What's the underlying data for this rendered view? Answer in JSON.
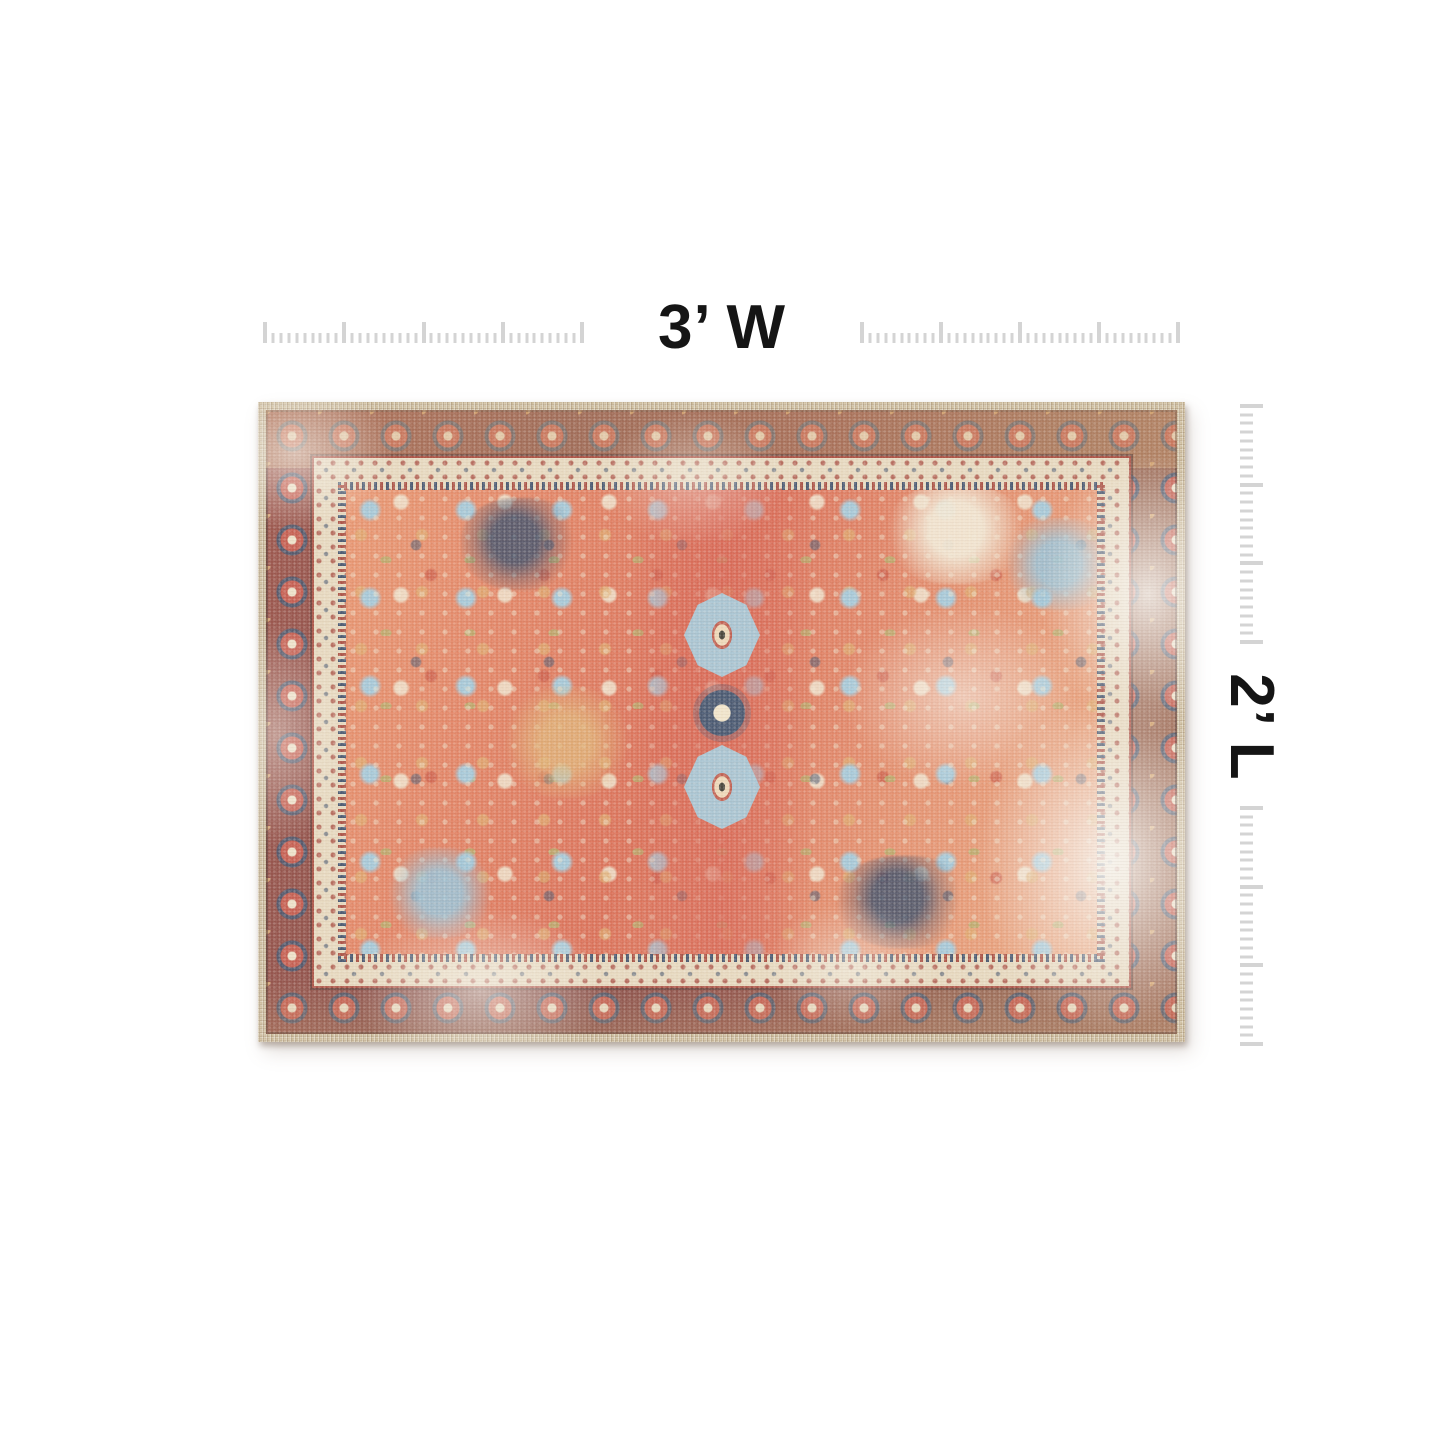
{
  "dimension_labels": {
    "width_label": "3’ W",
    "length_label": "2’ L"
  },
  "rulers": {
    "horizontal": {
      "majors": 5,
      "minors_between": 9
    },
    "vertical": {
      "majors": 4,
      "minors_between": 8
    }
  },
  "rug": {
    "alt": "Distressed vintage-style oriental area rug, terracotta field with multicolor medallion pattern and maroon rosette border",
    "width": "3 ft",
    "length": "2 ft"
  },
  "colors": {
    "label": "#151515",
    "tick": "#d4d4d4",
    "binding": "#ccbb9a",
    "border-base": "#8a4a42",
    "rosette-red": "#c3584a",
    "cream": "#ecdfc6",
    "guard": "#e6d7bc",
    "guard-line": "#a84b3e",
    "field-coral": "#e2855f",
    "field-deep": "#d96b52",
    "center-red": "#d65f4e",
    "powder-blue": "#a3c6d6",
    "navy": "#42526b",
    "olive": "#b3ab67",
    "gold": "#ddaa6b",
    "distress": "#f7f3ec"
  }
}
